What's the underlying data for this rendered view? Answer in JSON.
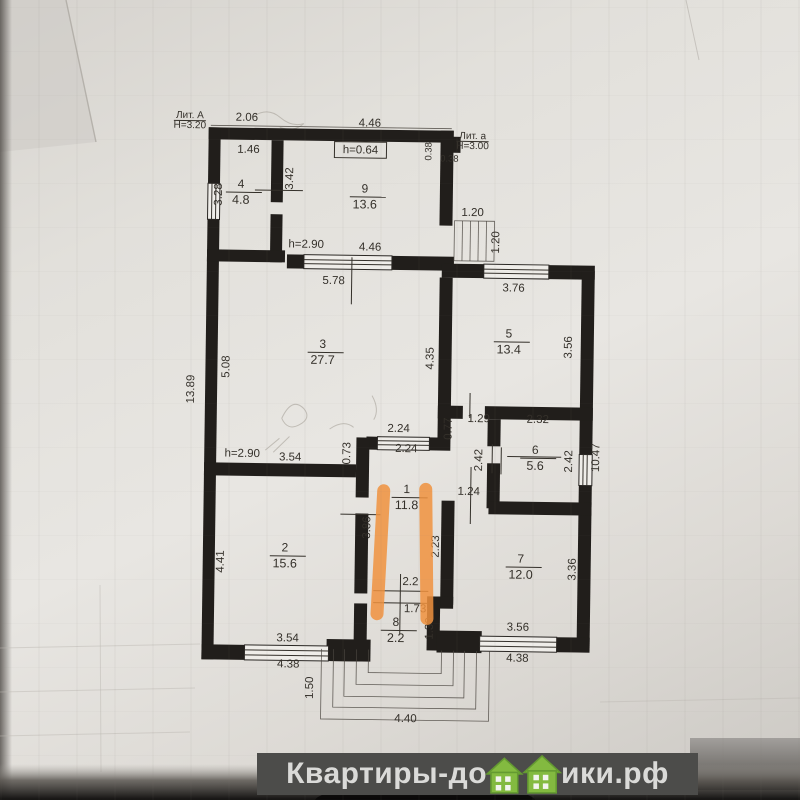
{
  "colors": {
    "wall": "#211e1b",
    "highlight": "#f0923e",
    "watermark_bar": "#4c4c4a",
    "watermark_text": "#dadad8",
    "house_green": "#83ba40"
  },
  "plan": {
    "rooms": [
      {
        "num": "4",
        "area": "4.8",
        "x": 238,
        "y": 193
      },
      {
        "num": "9",
        "area": "13.6",
        "x": 362,
        "y": 196
      },
      {
        "num": "3",
        "area": "27.7",
        "x": 322,
        "y": 352
      },
      {
        "num": "5",
        "area": "13.4",
        "x": 508,
        "y": 339
      },
      {
        "num": "6",
        "area": "5.6",
        "x": 536,
        "y": 455
      },
      {
        "num": "1",
        "area": "11.8",
        "x": 408,
        "y": 496
      },
      {
        "num": "2",
        "area": "15.6",
        "x": 287,
        "y": 556
      },
      {
        "num": "7",
        "area": "12.0",
        "x": 523,
        "y": 564
      },
      {
        "num": "8",
        "area": "2.2",
        "x": 399,
        "y": 629
      }
    ],
    "dims": [
      {
        "t": "Лит. А",
        "x": 186,
        "y": 121,
        "u": 1,
        "s": 10
      },
      {
        "t": "Н=3.20",
        "x": 186,
        "y": 131,
        "s": 10
      },
      {
        "t": "2.06",
        "x": 243,
        "y": 123
      },
      {
        "t": "4.46",
        "x": 366,
        "y": 127
      },
      {
        "t": "Лит. а",
        "x": 469,
        "y": 138,
        "u": 1,
        "s": 10
      },
      {
        "t": "Н=3.00",
        "x": 469,
        "y": 148,
        "s": 10
      },
      {
        "t": "1.46",
        "x": 245,
        "y": 155
      },
      {
        "t": "h=0.64",
        "x": 357,
        "y": 154,
        "box": 1
      },
      {
        "t": "0.38",
        "x": 446,
        "y": 161,
        "s": 9.5
      },
      {
        "t": "0.38",
        "x": 428,
        "y": 151,
        "v": 1,
        "s": 9.5
      },
      {
        "t": "1.20",
        "x": 470,
        "y": 215
      },
      {
        "t": "1.20",
        "x": 497,
        "y": 241,
        "v": 1
      },
      {
        "t": "3.28",
        "x": 219,
        "y": 197,
        "v": 1
      },
      {
        "t": "3.42",
        "x": 290,
        "y": 180,
        "v": 1
      },
      {
        "t": "h=2.90",
        "x": 304,
        "y": 249
      },
      {
        "t": "4.46",
        "x": 368,
        "y": 251
      },
      {
        "t": "5.78",
        "x": 332,
        "y": 285
      },
      {
        "t": "3.76",
        "x": 512,
        "y": 290
      },
      {
        "t": "5.08",
        "x": 229,
        "y": 369,
        "v": 1
      },
      {
        "t": "13.89",
        "x": 194,
        "y": 392,
        "v": 1
      },
      {
        "t": "4.35",
        "x": 433,
        "y": 358,
        "v": 1
      },
      {
        "t": "3.56",
        "x": 571,
        "y": 345,
        "v": 1
      },
      {
        "t": "1.29",
        "x": 479,
        "y": 421
      },
      {
        "t": "2.32",
        "x": 538,
        "y": 421
      },
      {
        "t": "0.77",
        "x": 452,
        "y": 428,
        "v": 1
      },
      {
        "t": "2.24",
        "x": 399,
        "y": 432
      },
      {
        "t": "2.24",
        "x": 407,
        "y": 452
      },
      {
        "t": "0.73",
        "x": 351,
        "y": 454,
        "v": 1
      },
      {
        "t": "2.42",
        "x": 483,
        "y": 459,
        "v": 1
      },
      {
        "t": "2.42",
        "x": 573,
        "y": 459,
        "v": 1
      },
      {
        "t": "10.47",
        "x": 600,
        "y": 455,
        "v": 1
      },
      {
        "t": "h=2.90",
        "x": 243,
        "y": 459
      },
      {
        "t": "3.54",
        "x": 291,
        "y": 462
      },
      {
        "t": "1.24",
        "x": 470,
        "y": 494
      },
      {
        "t": "3.86",
        "x": 372,
        "y": 528,
        "v": 1
      },
      {
        "t": "2.23",
        "x": 441,
        "y": 546,
        "v": 1
      },
      {
        "t": "4.41",
        "x": 226,
        "y": 564,
        "v": 1
      },
      {
        "t": "3.36",
        "x": 578,
        "y": 567,
        "v": 1
      },
      {
        "t": "2.2",
        "x": 413,
        "y": 585
      },
      {
        "t": "1.73",
        "x": 418,
        "y": 612
      },
      {
        "t": "1.30",
        "x": 436,
        "y": 628,
        "v": 1
      },
      {
        "t": "3.54",
        "x": 291,
        "y": 643
      },
      {
        "t": "3.56",
        "x": 521,
        "y": 629
      },
      {
        "t": "4.38",
        "x": 292,
        "y": 669
      },
      {
        "t": "4.38",
        "x": 521,
        "y": 660
      },
      {
        "t": "1.50",
        "x": 317,
        "y": 689,
        "v": 1
      },
      {
        "t": "4.40",
        "x": 410,
        "y": 722
      }
    ]
  },
  "watermark": {
    "left": "Квартиры-до",
    "right": "ики.рф"
  }
}
